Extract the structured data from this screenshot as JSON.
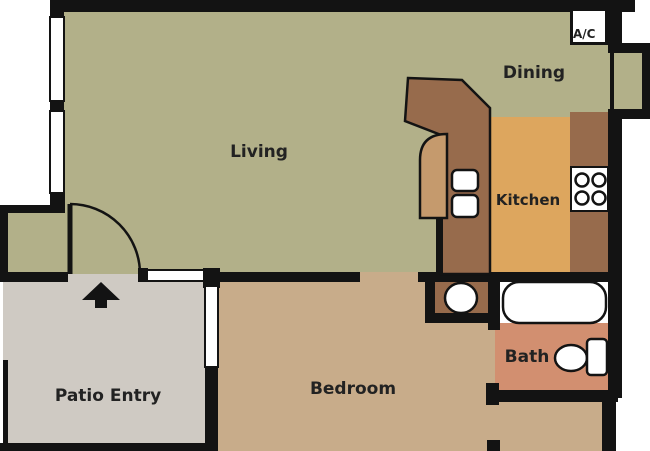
{
  "title": "Apartment Floor Plan",
  "rooms": {
    "living": {
      "label": "Living",
      "color": "#b2b089"
    },
    "dining": {
      "label": "Dining",
      "color": "#b2b089"
    },
    "kitchen": {
      "label": "Kitchen",
      "color": "#dda65e"
    },
    "bath": {
      "label": "Bath",
      "color": "#d28f70"
    },
    "bedroom": {
      "label": "Bedroom",
      "color": "#c8ac8a"
    },
    "patio_entry": {
      "label": "Patio Entry",
      "color": "#cfcac3"
    }
  },
  "units": {
    "ac": {
      "label": "A/C"
    }
  },
  "fixtures": {
    "bathtub": "bathtub",
    "toilet": "toilet",
    "vanity_sink": "vanity oval sink",
    "kitchen_sink": "double-basin kitchen sink",
    "stove": "4-burner stove",
    "peninsula": "kitchen peninsula counter",
    "entry_arrow": "entry direction arrow",
    "door_swing": "living room door swing"
  },
  "palette": {
    "wall": "#131313",
    "counter_brown": "#976b4c",
    "counter_tan": "#c59a6d",
    "fixture_white": "#ffffff",
    "text": "#222222",
    "background": "#ffffff"
  }
}
